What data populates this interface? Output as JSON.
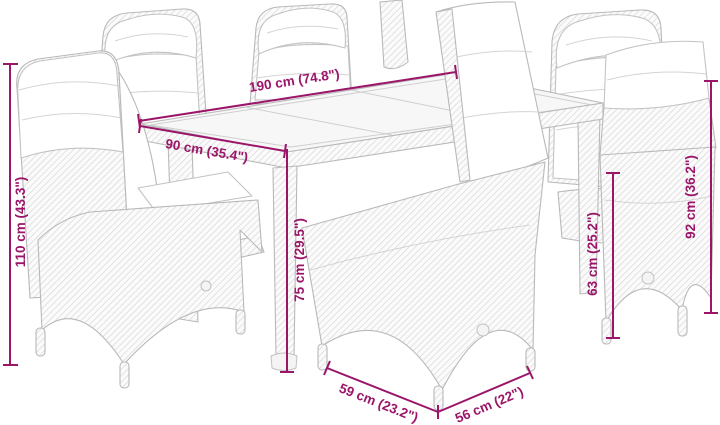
{
  "meta": {
    "image_type": "product-dimension-diagram",
    "subject": "7-piece poly rattan garden dining set: glass-top table with six reclining cushioned chairs, line-art drawing with dimension callouts"
  },
  "style": {
    "background": "#ffffff",
    "dimension_color": "#9b1669",
    "furniture_line_color": "#b9b9b9"
  },
  "dimensions": {
    "table_length": "190 cm (74.8\")",
    "table_width": "90 cm (35.4\")",
    "left_chair_height": "110 cm (43.3\")",
    "table_height": "75 cm (29.5\")",
    "seat_back_height": "63 cm (25.2\")",
    "right_chair_height": "92 cm (36.2\")",
    "chair_width": "59 cm (23.2\")",
    "chair_depth": "56 cm (22\")"
  }
}
